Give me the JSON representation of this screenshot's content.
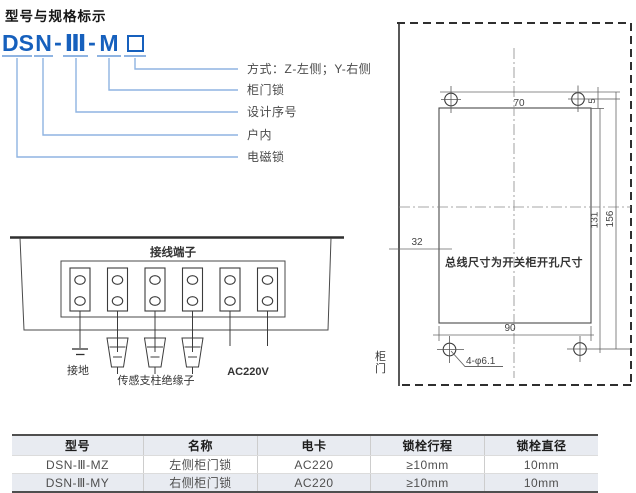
{
  "page_title": "型号与规格标示",
  "model_diagram": {
    "code": {
      "p1": "DS",
      "p2": "N",
      "dash1": "-",
      "p3": "Ⅲ",
      "dash2": "-",
      "p4": "M"
    },
    "labels": {
      "mode": "方式：Z-左侧；Y-右侧",
      "door_lock": "柜门锁",
      "design_no": "设计序号",
      "indoor": "户内",
      "magnet_lock": "电磁锁"
    }
  },
  "terminal_diagram": {
    "title": "接线端子",
    "ground": "接地",
    "insulator": "传感支柱绝缘子",
    "power": "AC220V"
  },
  "cutout_drawing": {
    "dims": {
      "d70": "70",
      "d5": "5",
      "d131": "131",
      "d156": "156",
      "d32": "32",
      "d90": "90"
    },
    "hole_callout": "4-φ6.1",
    "note": "总线尺寸为开关柜开孔尺寸",
    "door": "柜门"
  },
  "spec_table": {
    "headers": [
      "型号",
      "名称",
      "电卡",
      "锁栓行程",
      "锁栓直径"
    ],
    "rows": [
      [
        "DSN-Ⅲ-MZ",
        "左侧柜门锁",
        "AC220",
        "≥10mm",
        "10mm"
      ],
      [
        "DSN-Ⅲ-MY",
        "右侧柜门锁",
        "AC220",
        "≥10mm",
        "10mm"
      ]
    ]
  },
  "colors": {
    "code_blue": "#1660bd",
    "leader_blue": "#8fb4e2",
    "line_dark": "#3c3c3c",
    "table_border": "#4f4f4f",
    "row_shade": "#e8ebf1"
  }
}
